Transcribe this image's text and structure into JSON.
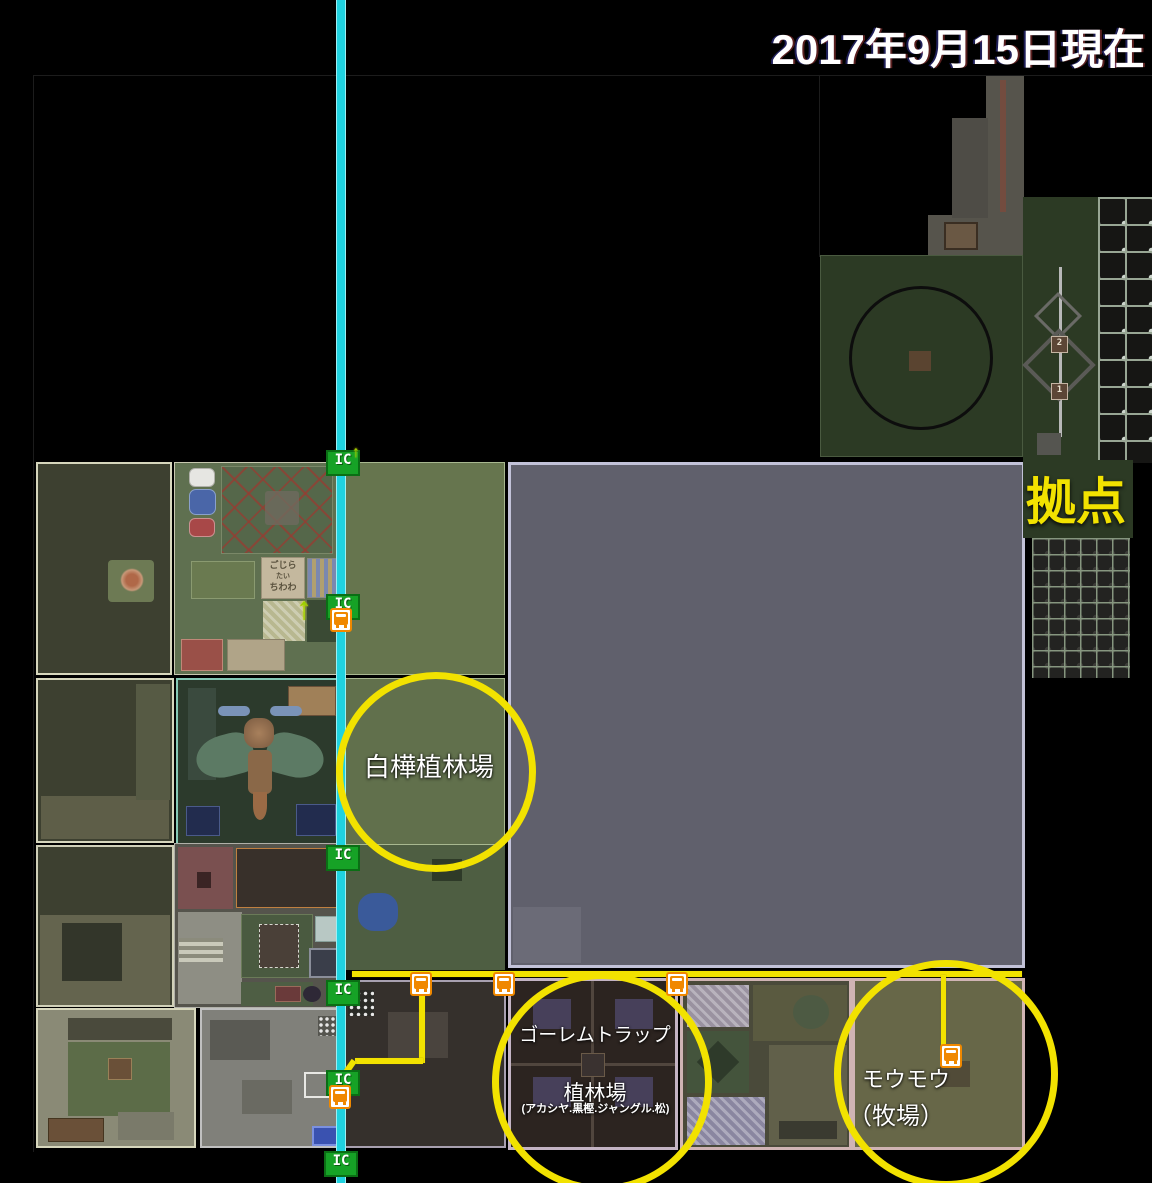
{
  "title": "2017年9月15日現在",
  "annotations": {
    "base_label": "拠点",
    "birch_plantation": "白樺植林場",
    "golem_trap_line1": "ゴーレムトラップ",
    "golem_trap_line2": "植林場",
    "golem_trap_line3": "(アカシヤ.黒樫.ジャングル.松)",
    "ranch_line1": "モウモウ",
    "ranch_line2": "（牧場）"
  },
  "rail": {
    "station_badge": "IC",
    "up_arrow": "↑"
  },
  "map_signs": {
    "gojira_sign": {
      "line1": "ごじら",
      "line2": "たい",
      "line3": "ちわわ"
    },
    "rail_marker_2": "2",
    "rail_marker_1": "1"
  },
  "colors": {
    "background": "#000000",
    "highlight_circle": "#f2e200",
    "annotation_text": "#ffffff",
    "base_text": "#f2e200",
    "main_rail": "#1fd2e0",
    "branch_rail": "#f2e200",
    "ic_badge_green": "#16a226",
    "minecart_orange": "#f08800",
    "big_gray_area": "#60606c"
  }
}
